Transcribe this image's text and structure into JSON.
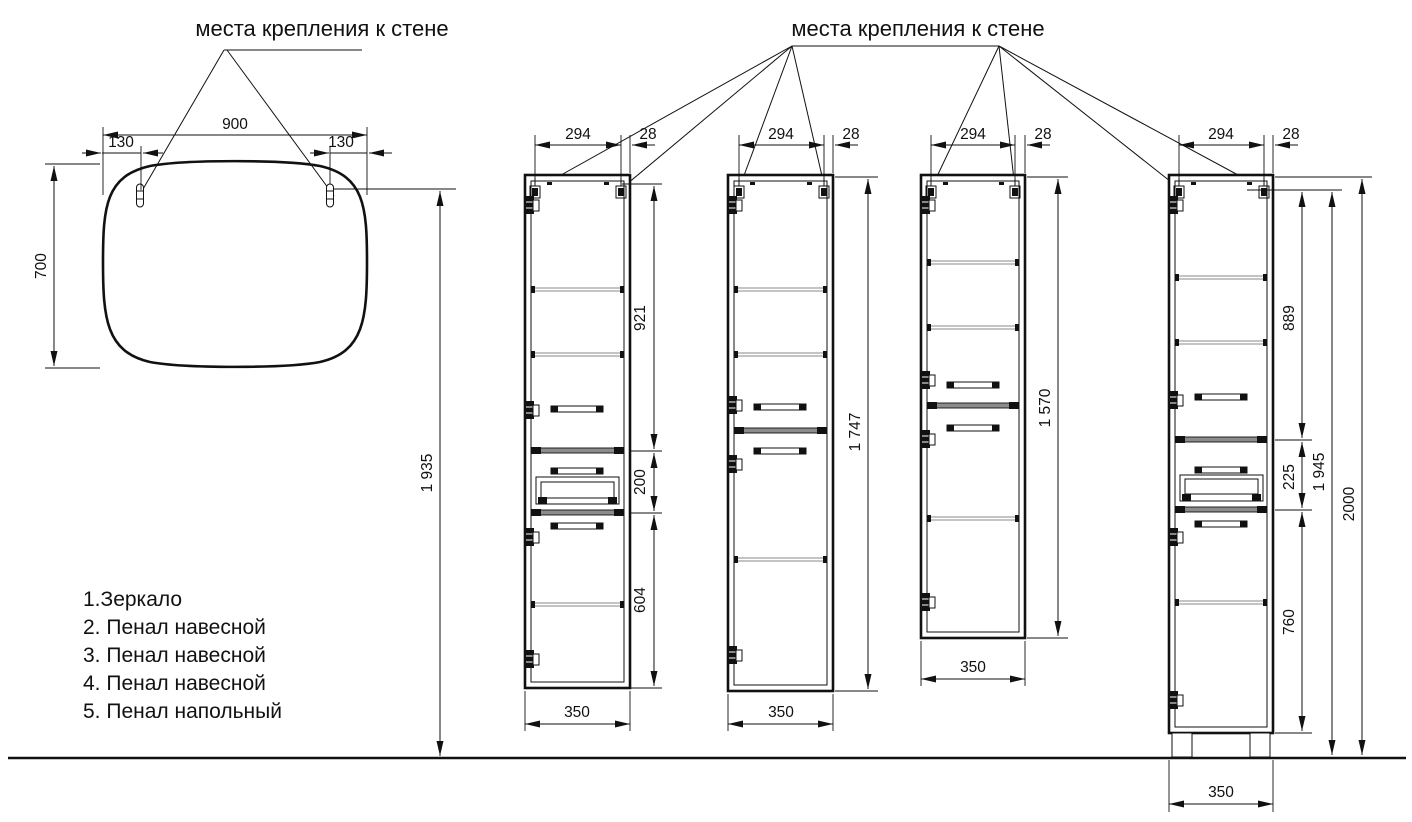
{
  "drawing": {
    "background": "#ffffff",
    "line_color": "#111111",
    "shelf_line_color": "#8a8a8a",
    "labels": {
      "mirror_title": "места крепления к стене",
      "cabinets_title": "места крепления к стене"
    },
    "legend": [
      "1.Зеркало",
      "2. Пенал навесной",
      "3. Пенал навесной",
      "4. Пенал навесной",
      "5. Пенал напольный"
    ],
    "mirror": {
      "width": "900",
      "offset_left": "130",
      "offset_right": "130",
      "height": "700",
      "mount_height": "1 935"
    },
    "cab2": {
      "mount_span": "294",
      "edge_offset": "28",
      "upper": "921",
      "middle": "200",
      "lower": "604",
      "width": "350"
    },
    "cab3": {
      "mount_span": "294",
      "edge_offset": "28",
      "height": "1 747",
      "width": "350"
    },
    "cab4": {
      "mount_span": "294",
      "edge_offset": "28",
      "height": "1 570",
      "width": "350"
    },
    "cab5": {
      "mount_span": "294",
      "edge_offset": "28",
      "upper": "889",
      "middle": "225",
      "lower": "760",
      "mount_height": "1 945",
      "total_height": "2000",
      "width": "350"
    }
  }
}
